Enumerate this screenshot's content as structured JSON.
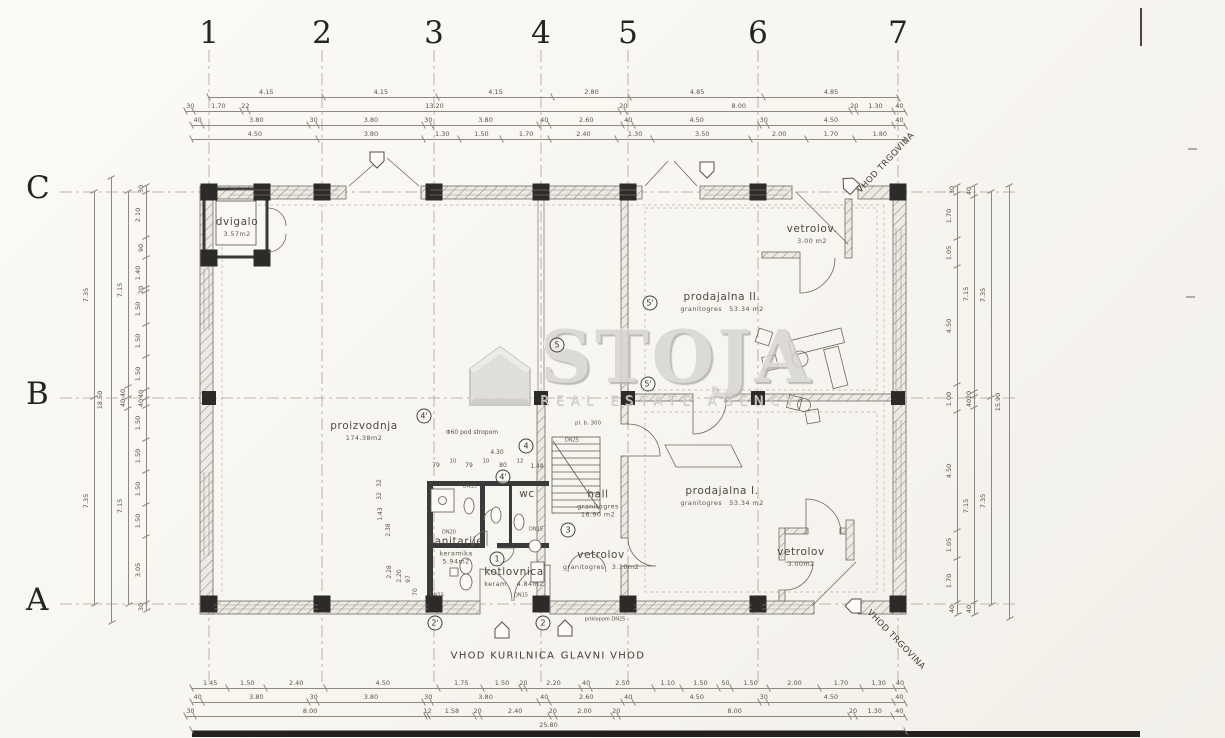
{
  "sheet": {
    "background": "#f7f5f0",
    "line_color": "#6f6a63",
    "wall_dark": "#2c2b29"
  },
  "watermark": {
    "title": "STOJA",
    "subtitle": "REAL ESTATE AGENCY",
    "icon": "house-icon",
    "color": "#d8d6d2"
  },
  "grid": {
    "columns": [
      {
        "label": "1",
        "x": 209
      },
      {
        "label": "2",
        "x": 322
      },
      {
        "label": "3",
        "x": 434
      },
      {
        "label": "4",
        "x": 541
      },
      {
        "label": "5",
        "x": 628
      },
      {
        "label": "6",
        "x": 758
      },
      {
        "label": "7",
        "x": 898
      }
    ],
    "rows": [
      {
        "label": "C",
        "y": 192
      },
      {
        "label": "B",
        "y": 398
      },
      {
        "label": "A",
        "y": 604
      }
    ]
  },
  "rooms": [
    {
      "id": "dvigalo",
      "name": "dvigalo",
      "area": "3.57m2",
      "x": 237,
      "y": 227
    },
    {
      "id": "proizvodnja",
      "name": "proizvodnja",
      "area": "174.38m2",
      "x": 364,
      "y": 431
    },
    {
      "id": "prodajalna-2",
      "name": "prodajalna II.",
      "material": "granitogres",
      "area": "53.34 m2",
      "x": 722,
      "y": 302
    },
    {
      "id": "vetrolov-top",
      "name": "vetrolov.",
      "area": "3.00 m2",
      "x": 812,
      "y": 234
    },
    {
      "id": "prodajalna-1",
      "name": "prodajalna I.",
      "material": "granitogres",
      "area": "53.34 m2",
      "x": 722,
      "y": 496
    },
    {
      "id": "hall",
      "name": "hall",
      "material": "granitogres",
      "area": "16.90 m2",
      "x": 598,
      "y": 504,
      "stack": true
    },
    {
      "id": "wc",
      "name": "wc",
      "x": 527,
      "y": 495
    },
    {
      "id": "vetrolov-main",
      "name": "vetrolov",
      "material": "granitogres",
      "area": "3.10m2",
      "x": 601,
      "y": 560
    },
    {
      "id": "sanitarije",
      "name": "sanitarije",
      "material": "keramika",
      "area": "5.94m2",
      "x": 456,
      "y": 551,
      "stack": true
    },
    {
      "id": "kotlovnica",
      "name": "kotlovnica",
      "material": "keram.",
      "area": "4.84m2",
      "x": 514,
      "y": 577
    },
    {
      "id": "vetrolov-bottom",
      "name": "vetrolov",
      "area": "3.00m2",
      "x": 801,
      "y": 557
    }
  ],
  "entrances": [
    {
      "id": "vhod-kurilnica",
      "label": "VHOD KURILNICA",
      "x": 503,
      "y": 656,
      "rotate": 0
    },
    {
      "id": "glavni-vhod",
      "label": "GLAVNI VHOD",
      "x": 603,
      "y": 656,
      "rotate": 0
    },
    {
      "id": "vhod-trgovina-top",
      "label": "VHOD TRGOVINA",
      "x": 886,
      "y": 163,
      "rotate": -47
    },
    {
      "id": "vhod-trgovina-bottom",
      "label": "VHOD TRGOVINA",
      "x": 896,
      "y": 640,
      "rotate": 46
    }
  ],
  "markers": [
    {
      "label": "1",
      "x": 497,
      "y": 559
    },
    {
      "label": "2'",
      "x": 435,
      "y": 623
    },
    {
      "label": "2",
      "x": 543,
      "y": 623
    },
    {
      "label": "3",
      "x": 568,
      "y": 530
    },
    {
      "label": "4'",
      "x": 424,
      "y": 416
    },
    {
      "label": "4",
      "x": 526,
      "y": 446
    },
    {
      "label": "4'",
      "x": 503,
      "y": 477
    },
    {
      "label": "5",
      "x": 557,
      "y": 345
    },
    {
      "label": "5'",
      "x": 650,
      "y": 303
    },
    {
      "label": "5'",
      "x": 648,
      "y": 384
    }
  ],
  "annotations": [
    {
      "text": "Φ60 pod stropom",
      "x": 472,
      "y": 433,
      "size": 6
    },
    {
      "text": "4.30",
      "x": 497,
      "y": 453,
      "size": 6
    },
    {
      "text": "79",
      "x": 436,
      "y": 466,
      "size": 6
    },
    {
      "text": "10",
      "x": 453,
      "y": 462,
      "size": 5.5
    },
    {
      "text": "79",
      "x": 469,
      "y": 466,
      "size": 6
    },
    {
      "text": "10",
      "x": 486,
      "y": 462,
      "size": 5.5
    },
    {
      "text": "80",
      "x": 503,
      "y": 466,
      "size": 6
    },
    {
      "text": "12",
      "x": 520,
      "y": 462,
      "size": 5.5
    },
    {
      "text": "1.48",
      "x": 537,
      "y": 467,
      "size": 6
    },
    {
      "text": "pl. b. 300",
      "x": 588,
      "y": 424,
      "size": 5.5
    },
    {
      "text": "DN25",
      "x": 572,
      "y": 441,
      "size": 5
    },
    {
      "text": "DN15",
      "x": 470,
      "y": 487,
      "size": 5
    },
    {
      "text": "DN20",
      "x": 449,
      "y": 533,
      "size": 5
    },
    {
      "text": "DN15",
      "x": 536,
      "y": 530,
      "size": 5
    },
    {
      "text": "DN15",
      "x": 437,
      "y": 596,
      "size": 5
    },
    {
      "text": "DN15",
      "x": 521,
      "y": 596,
      "size": 5
    },
    {
      "text": "priklopom DN25",
      "x": 605,
      "y": 620,
      "size": 5
    },
    {
      "text": "2.28",
      "x": 390,
      "y": 572,
      "size": 6,
      "rotate": -90
    },
    {
      "text": "2.20",
      "x": 400,
      "y": 576,
      "size": 6,
      "rotate": -90
    },
    {
      "text": "97",
      "x": 409,
      "y": 579,
      "size": 6,
      "rotate": -90
    },
    {
      "text": "70",
      "x": 416,
      "y": 592,
      "size": 6,
      "rotate": -90
    },
    {
      "text": "32",
      "x": 380,
      "y": 483,
      "size": 6,
      "rotate": -90
    },
    {
      "text": "32",
      "x": 380,
      "y": 496,
      "size": 6,
      "rotate": -90
    },
    {
      "text": "1.43",
      "x": 381,
      "y": 514,
      "size": 6,
      "rotate": -90
    },
    {
      "text": "2.38",
      "x": 389,
      "y": 530,
      "size": 6,
      "rotate": -90
    }
  ],
  "dimensions": {
    "top": [
      {
        "y": 96,
        "x1": 209,
        "x2": 898,
        "values": [
          "4.15",
          "4.15",
          "4.15",
          "2.80",
          "4.85",
          "4.85"
        ]
      },
      {
        "y": 110,
        "x1": 186,
        "x2": 905,
        "values": [
          "30",
          "1.70",
          "22",
          "13.20",
          "20",
          "8.00",
          "20",
          "1.30",
          "40"
        ]
      },
      {
        "y": 124,
        "x1": 192,
        "x2": 905,
        "values": [
          "40",
          "3.80",
          "30",
          "3.80",
          "30",
          "3.80",
          "40",
          "2.60",
          "40",
          "4.50",
          "30",
          "4.50",
          "40"
        ]
      },
      {
        "y": 138,
        "x1": 192,
        "x2": 905,
        "values": [
          "4.50",
          "3.80",
          "1.30",
          "1.50",
          "1.70",
          "2.40",
          "1.30",
          "3.50",
          "2.00",
          "1.70",
          "1.80"
        ]
      }
    ],
    "bottom": [
      {
        "y": 687,
        "x1": 192,
        "x2": 905,
        "values": [
          "1.45",
          "1.50",
          "2.40",
          "4.50",
          "1.75",
          "1.50",
          "20",
          "2.20",
          "40",
          "2.50",
          "1.10",
          "1.50",
          "50",
          "1.50",
          "2.00",
          "1.70",
          "1.30",
          "40"
        ]
      },
      {
        "y": 701,
        "x1": 192,
        "x2": 905,
        "values": [
          "40",
          "3.80",
          "30",
          "3.80",
          "30",
          "3.80",
          "40",
          "2.60",
          "40",
          "4.50",
          "30",
          "4.50",
          "40"
        ]
      },
      {
        "y": 715,
        "x1": 186,
        "x2": 905,
        "values": [
          "30",
          "8.00",
          "12",
          "1.58",
          "20",
          "2.40",
          "20",
          "2.00",
          "20",
          "8.00",
          "20",
          "1.30",
          "40"
        ]
      },
      {
        "y": 729,
        "x1": 192,
        "x2": 905,
        "values": [
          "25.80"
        ]
      }
    ],
    "left": [
      {
        "x": 94,
        "y1": 192,
        "y2": 604,
        "values": [
          "7.35",
          "7.35"
        ]
      },
      {
        "x": 111,
        "y1": 178,
        "y2": 622,
        "values": [
          "18.50"
        ]
      },
      {
        "x": 128,
        "y1": 192,
        "y2": 604,
        "values": [
          "7.15",
          "40",
          "40",
          "7.15"
        ]
      },
      {
        "x": 146,
        "y1": 186,
        "y2": 610,
        "values": [
          "30",
          "2.10",
          "90",
          "1.40",
          "20",
          "1.50",
          "1.50",
          "1.50",
          "40",
          "40",
          "1.50",
          "1.50",
          "1.50",
          "1.50",
          "3.05",
          "30"
        ]
      }
    ],
    "right": [
      {
        "x": 957,
        "y1": 186,
        "y2": 614,
        "values": [
          "30",
          "1.70",
          "1.05",
          "4.50",
          "1.00",
          "4.50",
          "1.05",
          "1.70",
          "40"
        ]
      },
      {
        "x": 974,
        "y1": 186,
        "y2": 614,
        "values": [
          "40",
          "7.15",
          "20",
          "40",
          "7.15",
          "40"
        ]
      },
      {
        "x": 991,
        "y1": 192,
        "y2": 604,
        "values": [
          "7.35",
          "7.35"
        ]
      },
      {
        "x": 1009,
        "y1": 186,
        "y2": 618,
        "values": [
          "15.90"
        ]
      }
    ]
  }
}
